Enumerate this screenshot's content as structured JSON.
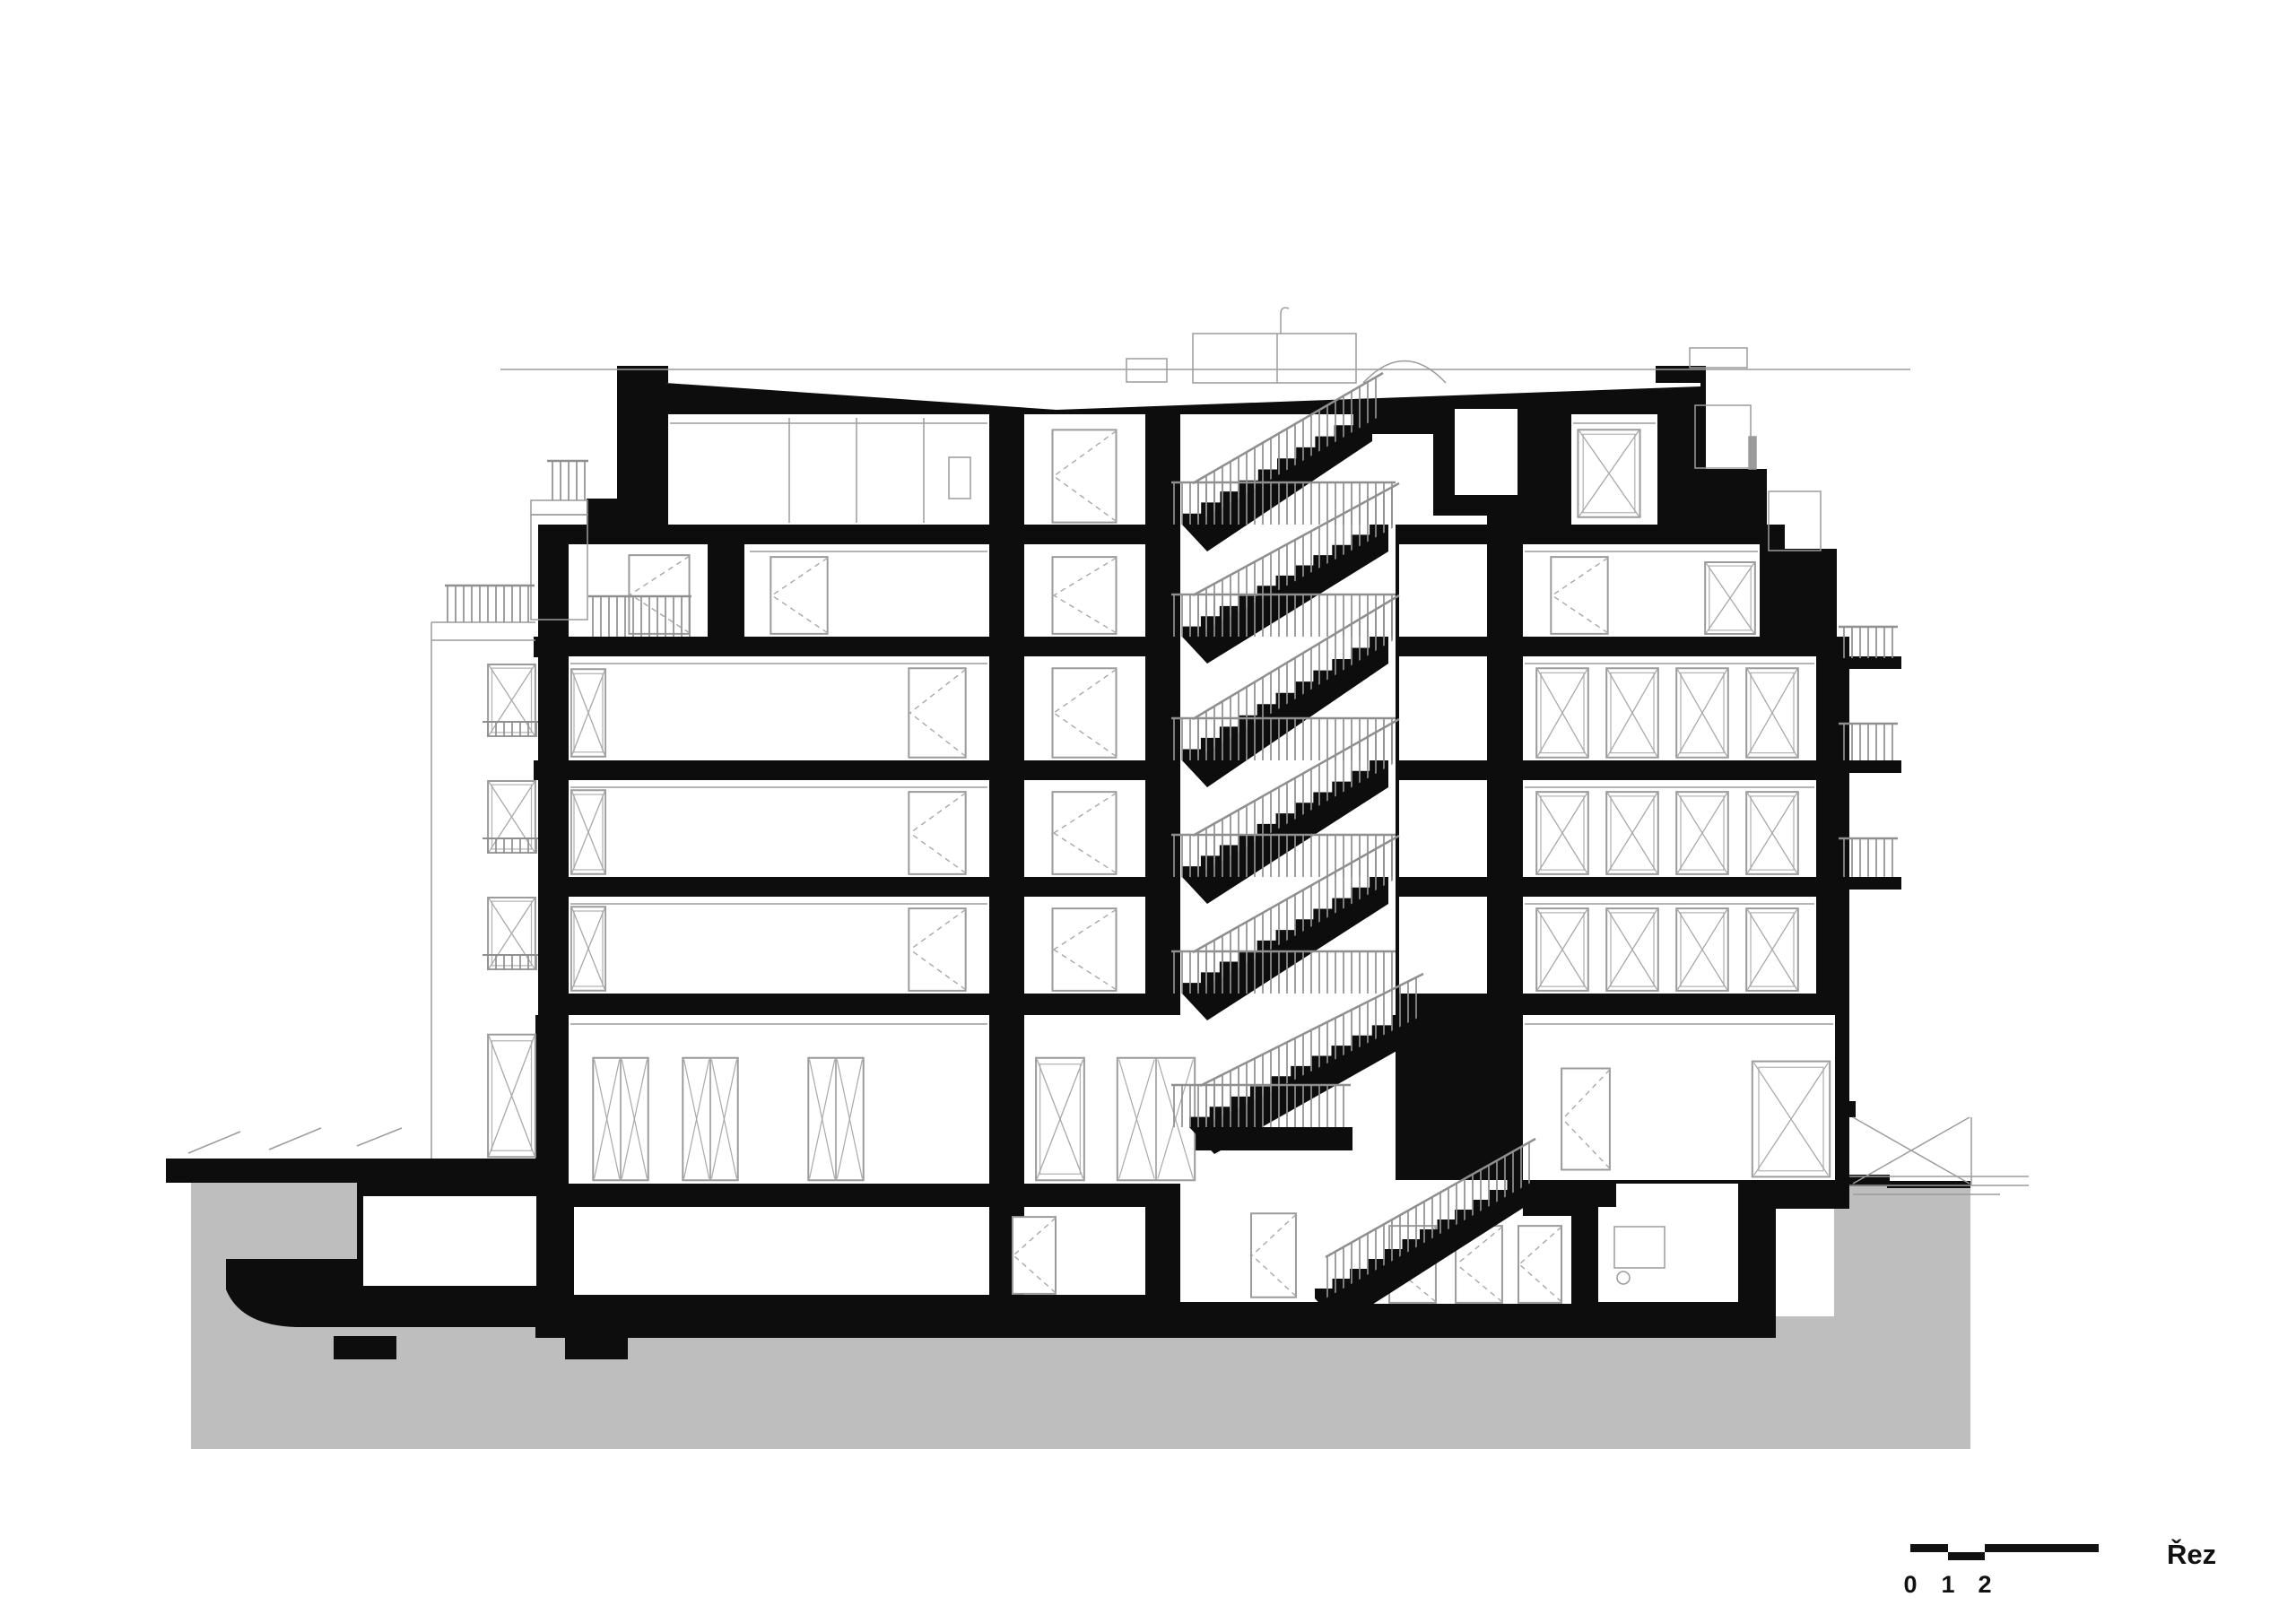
{
  "drawing": {
    "name": "building-cross-section",
    "kind": "architectural section drawing",
    "title": "Řez",
    "colors": {
      "cut_poche": "#0d0d0d",
      "ground_fill": "#bebebe",
      "elevation_line": "#9b9b9b",
      "background": "#ffffff"
    }
  },
  "scalebar": {
    "labels": [
      "0",
      "1",
      "2",
      "5"
    ]
  }
}
